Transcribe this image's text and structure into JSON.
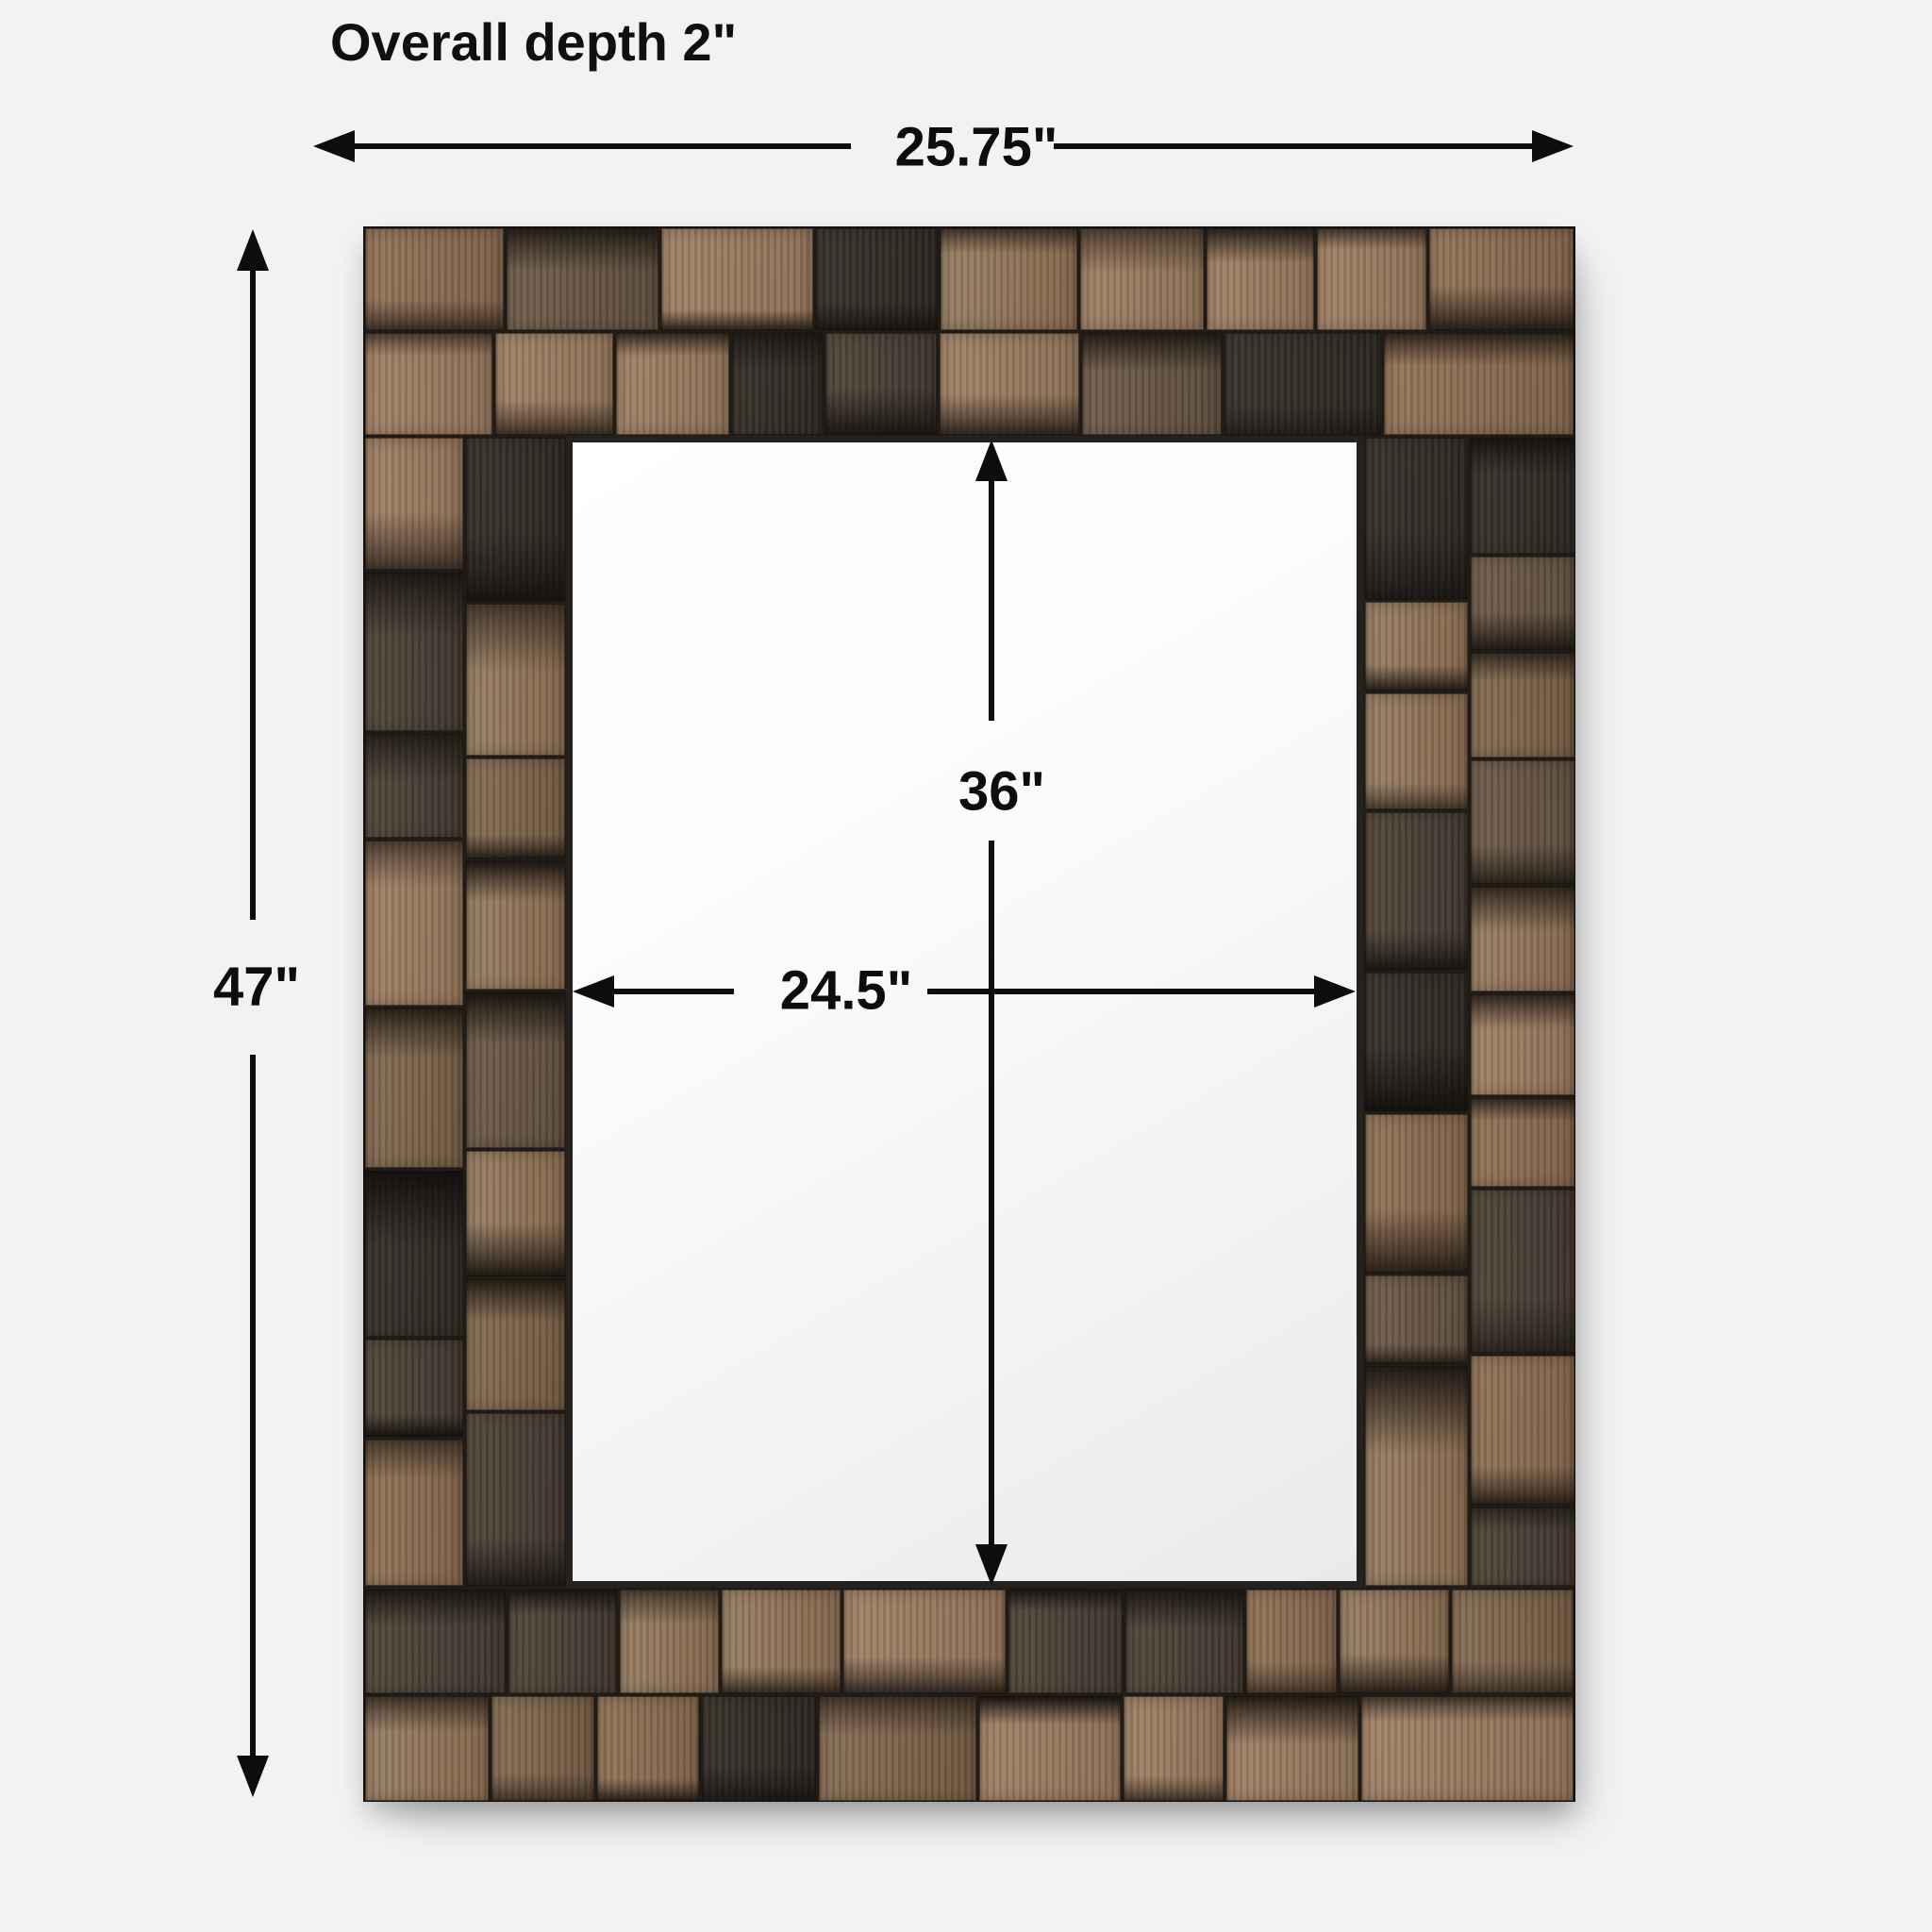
{
  "title": "Overall depth 2\"",
  "dimensions": {
    "overall_width": "25.75\"",
    "overall_height": "47\"",
    "overall_depth": "2\"",
    "mirror_width": "24.5\"",
    "mirror_height": "36\""
  },
  "colors": {
    "page_background": "#f1f2f1",
    "dimension_ink": "#0d0d0d",
    "mirror_surface_light": "#fcfcfc",
    "mirror_surface_dark": "#e9eaea",
    "frame_seam": "#1f1b17",
    "wood_palette": [
      [
        "#a5856a",
        "#8c6f55"
      ],
      [
        "#96785c",
        "#7d6048"
      ],
      [
        "#9b8267",
        "#84674c"
      ],
      [
        "#8a7158",
        "#6e573f"
      ],
      [
        "#74614f",
        "#5a4a3b"
      ],
      [
        "#564a3e",
        "#3e352c"
      ],
      [
        "#3b352e",
        "#2a2620"
      ]
    ]
  }
}
